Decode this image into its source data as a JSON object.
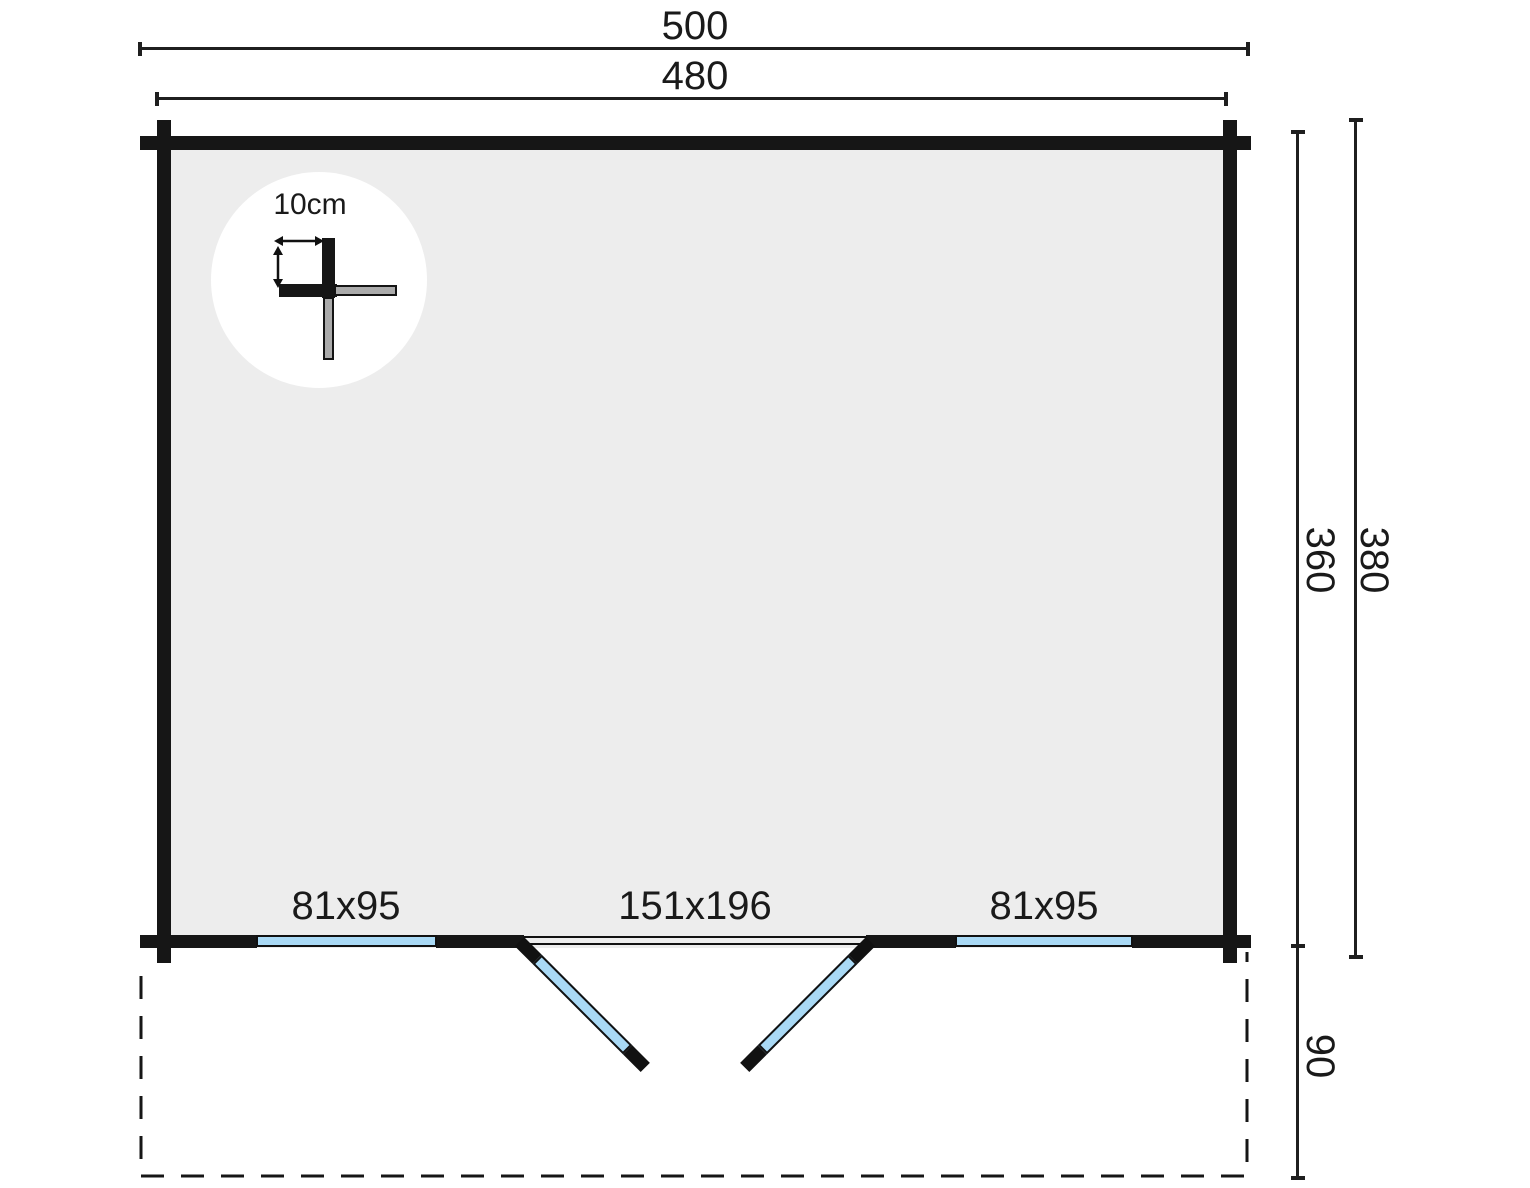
{
  "drawing": {
    "top_dimensions": {
      "overall_width": "500",
      "inner_width": "480"
    },
    "side_dimensions": {
      "inner_depth": "360",
      "overall_depth": "380",
      "terrace_depth": "90"
    },
    "detail": {
      "wall_thickness": "10cm"
    },
    "openings": {
      "left_window": {
        "label": "81x95"
      },
      "double_door": {
        "label": "151x196"
      },
      "right_window": {
        "label": "81x95"
      }
    },
    "colors": {
      "wall": "#161616",
      "floor": "#ededed",
      "glass": "#a9d9f5",
      "log_end": "#ababab",
      "dim_line": "#1f1f1f",
      "background": "#ffffff"
    }
  }
}
